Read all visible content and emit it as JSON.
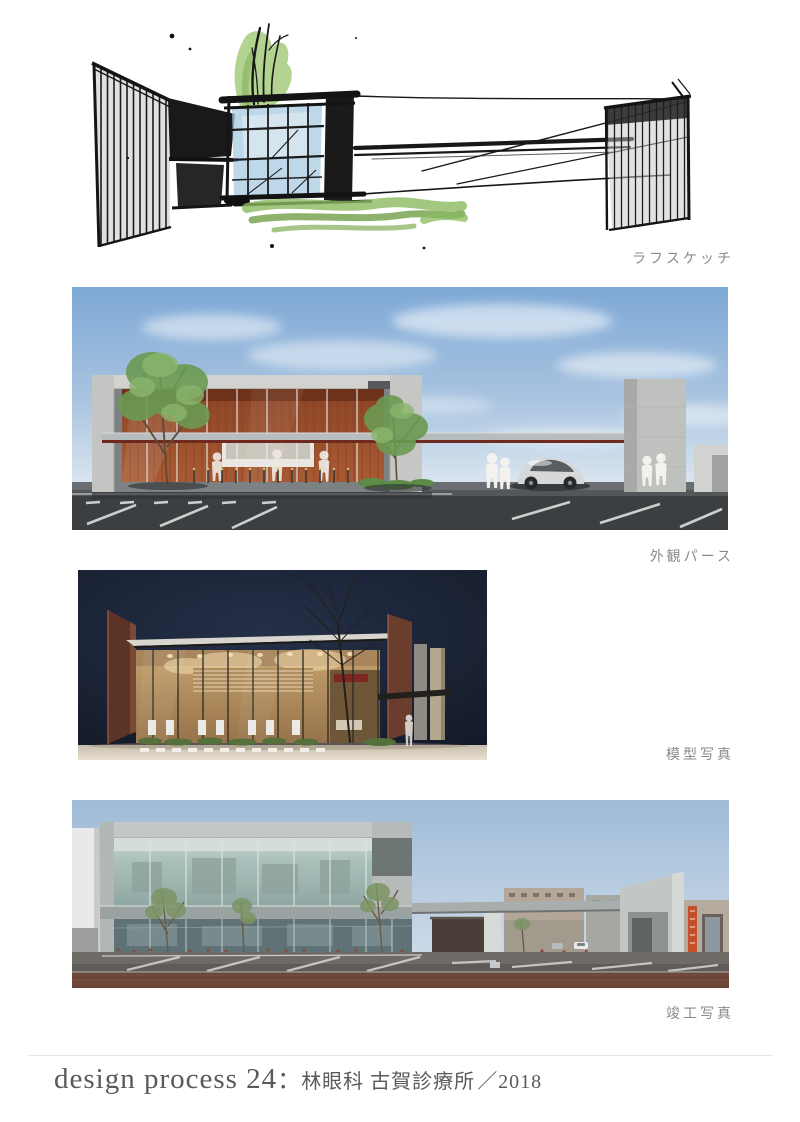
{
  "page": {
    "width": 800,
    "height": 1122,
    "background": "#ffffff"
  },
  "sections": [
    {
      "id": "rough-sketch",
      "caption": "ラフスケッチ"
    },
    {
      "id": "exterior-perspective",
      "caption": "外観パース"
    },
    {
      "id": "model-photo",
      "caption": "模型写真"
    },
    {
      "id": "completion-photo",
      "caption": "竣工写真"
    }
  ],
  "footer": {
    "series_title": "design process 24",
    "separator": "：",
    "project_name": "林眼科 古賀診療所",
    "year": "／2018"
  },
  "palette": {
    "caption_text": "#8a8a8a",
    "footer_text": "#5a5a5a",
    "divider": "#e7e7e7",
    "sketch_ink": "#1a1a1a",
    "sketch_green": "#8fba5f",
    "sketch_blue": "#aacbe2",
    "render_sky": "#7ea9d6",
    "render_wood": "#9a5230",
    "model_background": "#1a2230",
    "model_wood": "#c7a36e",
    "photo_sky": "#9fbbd8",
    "photo_sign_orange": "#c4502a",
    "photo_pavement": "#6b4438"
  }
}
